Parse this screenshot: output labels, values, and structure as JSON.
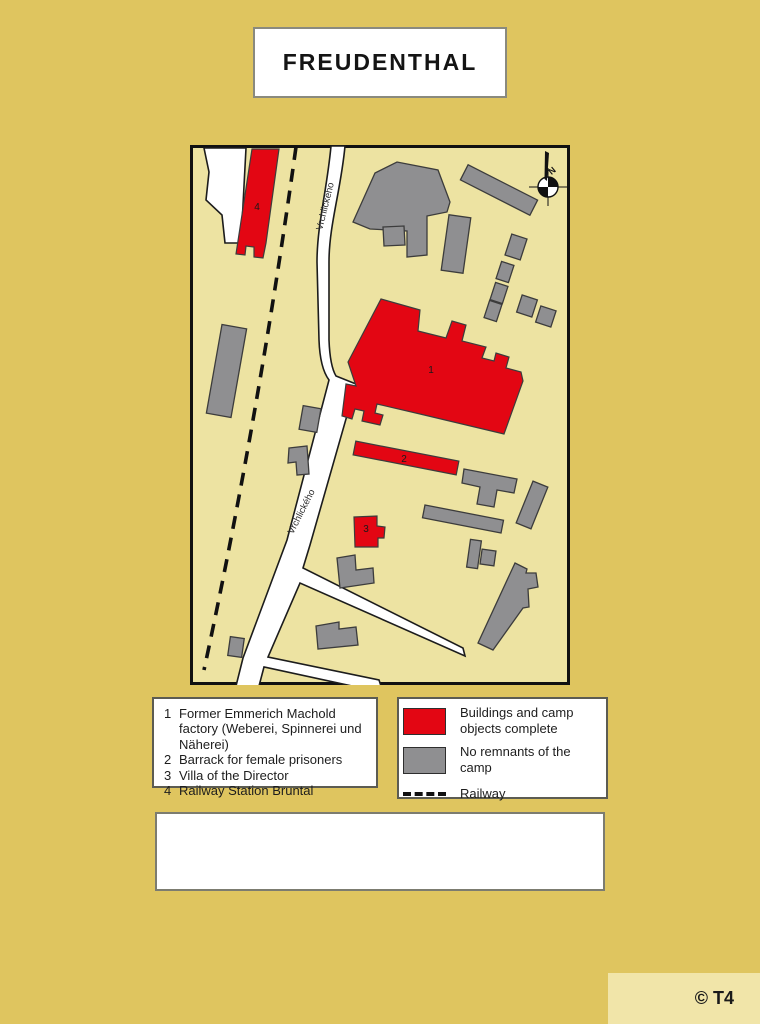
{
  "title": "FREUDENTHAL",
  "map": {
    "street_label": "Vrchlického",
    "compass_n": "N",
    "building_labels": {
      "factory": "1",
      "barrack": "2",
      "villa": "3",
      "station": "4"
    }
  },
  "legend_numbered": {
    "items": [
      {
        "num": "1",
        "text": "Former Emmerich Machold factory (Weberei, Spinnerei und Näherei)"
      },
      {
        "num": "2",
        "text": "Barrack for female prisoners"
      },
      {
        "num": "3",
        "text": "Villa of the Director"
      },
      {
        "num": "4",
        "text": "Railway Station Bruntal"
      }
    ]
  },
  "legend_symbols": {
    "items": [
      {
        "symbol": "red-swatch",
        "text": "Buildings and camp objects complete"
      },
      {
        "symbol": "gray-swatch",
        "text": "No remnants of the camp"
      },
      {
        "symbol": "railway-dash",
        "text": "Railway"
      }
    ]
  },
  "footer": {
    "credit": "© T4"
  },
  "colors": {
    "page_bg": "#dfc55f",
    "map_bg": "#ede3a2",
    "building_red": "#e30613",
    "building_gray": "#8f8f91",
    "panel_bg": "#f1e5a9"
  }
}
